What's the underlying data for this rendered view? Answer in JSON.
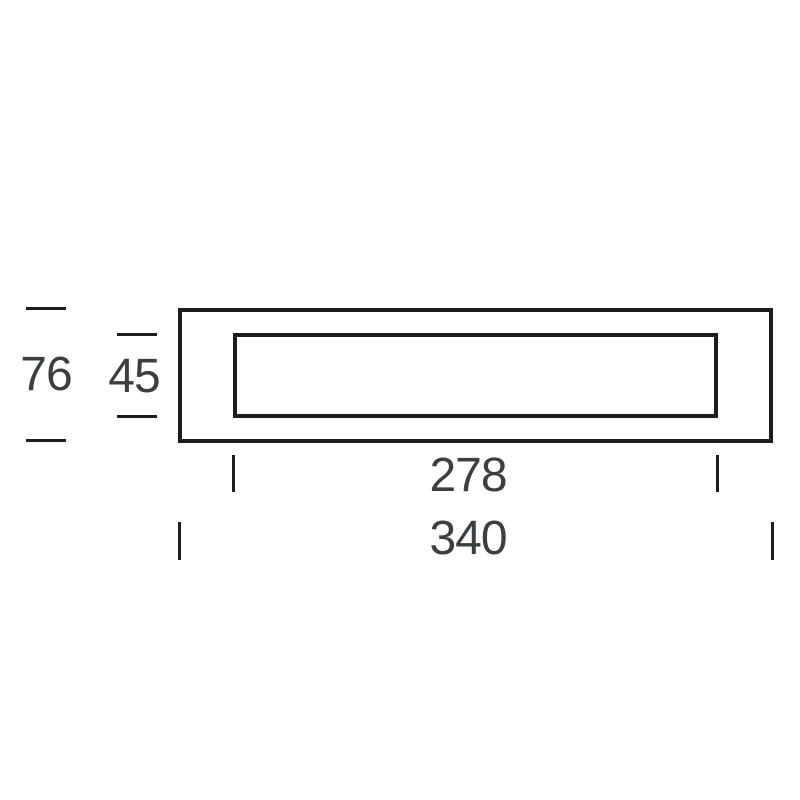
{
  "drawing": {
    "type": "dimension-diagram",
    "colors": {
      "background": "#ffffff",
      "line": "#1d1d1b",
      "text": "#3b3f42"
    },
    "dimensions": {
      "outer_height": "76",
      "inner_height": "45",
      "inner_width": "278",
      "outer_width": "340"
    }
  }
}
